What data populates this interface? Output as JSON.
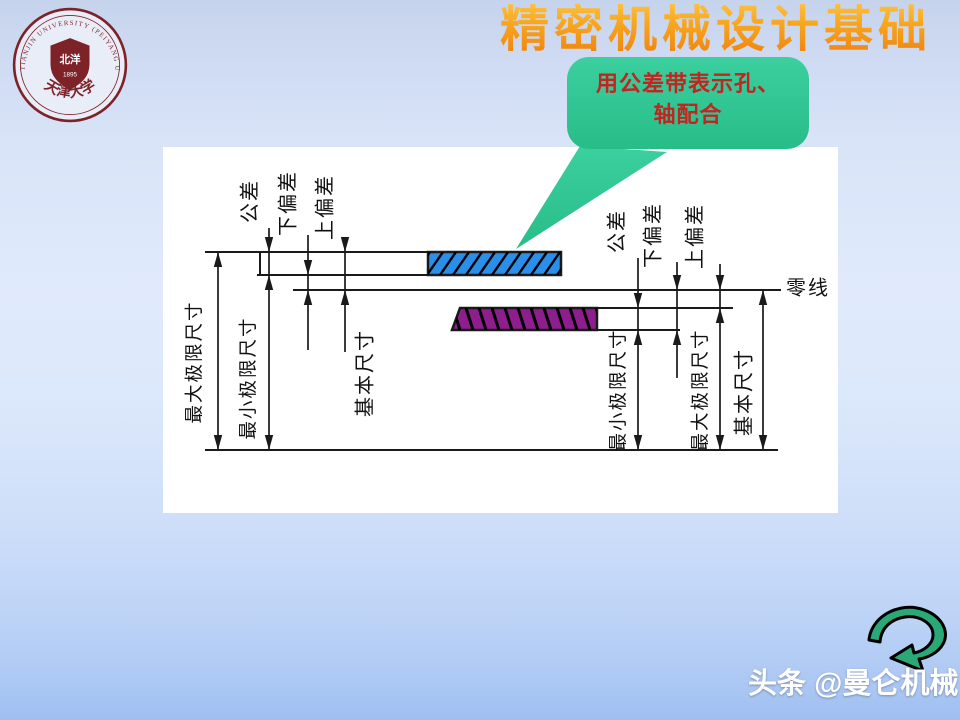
{
  "slide": {
    "title": "精密机械设计基础"
  },
  "logo": {
    "ring_text": "TIANJIN UNIVERSITY (PEIYANG UNIVERSITY)",
    "shield_name": "北洋",
    "year": "1895",
    "university_name": "天津大学"
  },
  "callout": {
    "line1": "用公差带表示孔、",
    "line2": "轴配合"
  },
  "brand": {
    "platform": "头条",
    "handle": "@曼仑机械"
  },
  "colors": {
    "title_gradient_top": "#ffd257",
    "title_gradient_bottom": "#ee7d0d",
    "callout_bg": "#2fc795",
    "callout_text": "#c42320",
    "hole_zone_fill": "#2b8ee8",
    "shaft_zone_fill": "#8e1d8e",
    "seal_color": "#7d2328",
    "line_color": "#1a1a1a"
  },
  "diagram": {
    "zero_line_label": "零线",
    "lines": [
      [
        205,
        252,
        561,
        252
      ],
      [
        257,
        275,
        561,
        275
      ],
      [
        293,
        290,
        781,
        290
      ],
      [
        460,
        308,
        733,
        308
      ],
      [
        452,
        330,
        680,
        330
      ],
      [
        205,
        450,
        778,
        450
      ],
      [
        260,
        252,
        260,
        275
      ]
    ],
    "hole_bar": {
      "x": 260,
      "y": 252,
      "w": 301,
      "h": 23
    },
    "hole_zone": {
      "x": 428,
      "y": 252,
      "w": 133,
      "h": 23
    },
    "shaft_zone": {
      "points": "460,308 597,308 597,330 452,330"
    },
    "dims": [
      {
        "x": 218,
        "y1": 252,
        "y2": 450,
        "arrows": [
          [
            "up",
            252
          ],
          [
            "down",
            450
          ]
        ]
      },
      {
        "x": 269,
        "y1": 228,
        "y2": 450,
        "arrows": [
          [
            "down",
            252
          ],
          [
            "up",
            275
          ],
          [
            "down",
            450
          ]
        ]
      },
      {
        "x": 308,
        "y1": 235,
        "y2": 350,
        "arrows": [
          [
            "down",
            275
          ],
          [
            "up",
            290
          ]
        ]
      },
      {
        "x": 345,
        "y1": 240,
        "y2": 352,
        "arrows": [
          [
            "down",
            252
          ],
          [
            "up",
            290
          ]
        ]
      },
      {
        "x": 638,
        "y1": 258,
        "y2": 450,
        "arrows": [
          [
            "down",
            308
          ],
          [
            "up",
            330
          ],
          [
            "down",
            450
          ]
        ]
      },
      {
        "x": 677,
        "y1": 262,
        "y2": 378,
        "arrows": [
          [
            "down",
            290
          ],
          [
            "up",
            330
          ]
        ]
      },
      {
        "x": 720,
        "y1": 264,
        "y2": 450,
        "arrows": [
          [
            "down",
            290
          ],
          [
            "up",
            308
          ],
          [
            "down",
            450
          ]
        ]
      },
      {
        "x": 763,
        "y1": 290,
        "y2": 450,
        "arrows": [
          [
            "up",
            290
          ],
          [
            "down",
            450
          ]
        ]
      }
    ],
    "labels": [
      {
        "name": "label-hole-tolerance",
        "text": "公差",
        "x": 252,
        "y": 201,
        "rot": -90
      },
      {
        "name": "label-hole-lower-dev",
        "text": "下偏差",
        "x": 290,
        "y": 203,
        "rot": -90
      },
      {
        "name": "label-hole-upper-dev",
        "text": "上偏差",
        "x": 327,
        "y": 207,
        "rot": -90
      },
      {
        "name": "label-hole-max-size",
        "text": "最大极限尺寸",
        "x": 196,
        "y": 362,
        "rot": -90
      },
      {
        "name": "label-hole-min-size",
        "text": "最小极限尺寸",
        "x": 250,
        "y": 378,
        "rot": -90
      },
      {
        "name": "label-hole-basic-size",
        "text": "基本尺寸",
        "x": 367,
        "y": 373,
        "rot": -90
      },
      {
        "name": "label-shaft-tolerance",
        "text": "公差",
        "x": 619,
        "y": 231,
        "rot": -90
      },
      {
        "name": "label-shaft-lower-dev",
        "text": "下偏差",
        "x": 655,
        "y": 235,
        "rot": -90
      },
      {
        "name": "label-shaft-upper-dev",
        "text": "上偏差",
        "x": 697,
        "y": 236,
        "rot": -90
      },
      {
        "name": "label-shaft-min-size",
        "text": "最小极限尺寸",
        "x": 620,
        "y": 390,
        "rot": -90
      },
      {
        "name": "label-shaft-max-size",
        "text": "最大极限尺寸",
        "x": 702,
        "y": 390,
        "rot": -90
      },
      {
        "name": "label-shaft-basic-size",
        "text": "基本尺寸",
        "x": 746,
        "y": 392,
        "rot": -90
      },
      {
        "name": "label-zero-line",
        "text": "零线",
        "x": 808,
        "y": 290,
        "rot": 0
      }
    ]
  }
}
